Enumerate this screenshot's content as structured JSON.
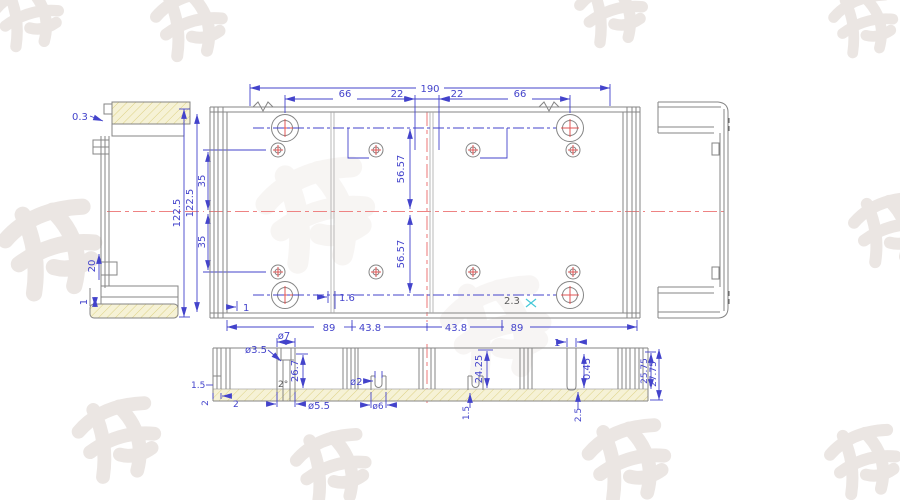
{
  "title": "Aluminium enclosure CAD drawing",
  "colors": {
    "dimension": "#4343cb",
    "line": "#858585",
    "centerline": "#ee8383",
    "hatch_fill": "#f6f2d6",
    "hatch_stroke": "#dcd183",
    "cyan_mark": "#45c8d8",
    "dark_label": "#5a5a5a",
    "watermark": "#ebe6e3"
  },
  "plan_view": {
    "width_total": "190",
    "width_left": "66",
    "width_center_left": "22",
    "width_center_right": "22",
    "width_right": "66",
    "height_total": "122.5",
    "height_inner": "122.5",
    "offset_upper": "35",
    "offset_lower": "35",
    "pitch_upper": "56.57",
    "pitch_lower": "56.57",
    "bottom_left": "89",
    "bottom_center_left": "43.8",
    "bottom_center_right": "43.8",
    "bottom_right": "89",
    "boss_wall": "1",
    "rib": "1.6",
    "wall": "2.3"
  },
  "left_view": {
    "lip": "0.3",
    "tab": "20",
    "base": "1"
  },
  "section_view": {
    "bore_small": "ø3.5",
    "bore_large": "ø7",
    "boss_height": "26.7",
    "draft": "2°",
    "boss_dia": "ø5.5",
    "corner_a": "1.5",
    "corner_b": "2",
    "corner_c": "2",
    "channel_bore": "ø2",
    "channel_dia": "ø6",
    "height_a": "24.25",
    "channel_offset": "1.5",
    "slot_width": "1",
    "taper": "0.45",
    "base_thk": "2.5",
    "height_b": "25.75",
    "height_c": "27.75"
  },
  "watermark": {
    "characters": [
      "顺",
      "达",
      "鸿",
      "发"
    ]
  }
}
